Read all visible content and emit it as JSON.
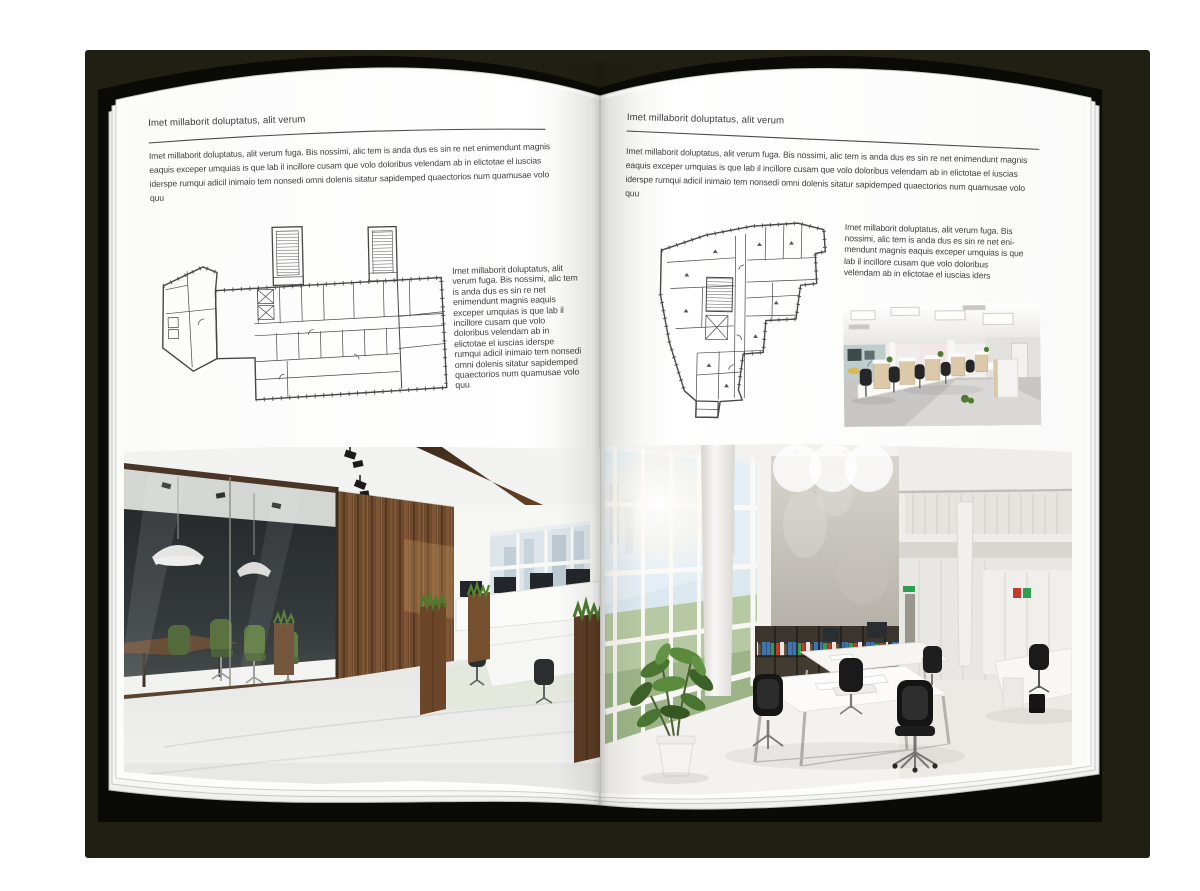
{
  "scene": {
    "type": "open-magazine-spread-mockup",
    "backdrop_color": "#201f13",
    "cover_color": "#0a0a06",
    "page_color": "#ffffff",
    "text_color": "#3e3e3e"
  },
  "left_page": {
    "header": "Imet millaborit doluptatus, alit verum",
    "intro": "Imet millaborit doluptatus, alit verum fuga. Bis nossimi, alic tem is anda dus es sin re net enimendunt magnis eaquis exceper umquias is que lab il incillore cusam que volo doloribus velendam ab in elictotae el iuscias iderspe rumqui adicil inimaio tem nonsedi omni dolenis sitatur sapidemped quaectorios num quamusae volo quu",
    "side_text": "Imet millaborit doluptatus, alit verum fuga. Bis nossimi, alic tem is anda dus es sin re net enimendunt magnis eaquis exceper umquias is que lab il incillore cusam que volo doloribus velendam ab in elictotae el iuscias iderspe rumqui adicil inimaio tem nonsedi omni dolenis sitatur sapidemped quaectorios num quamusae volo quu",
    "floor_plan": "architectural-floor-plan-wide-building-with-two-stair-towers",
    "photo": "office-interior-dark-wood-wall-glass-meeting-room-green-chairs"
  },
  "right_page": {
    "header": "Imet millaborit doluptatus, alit verum",
    "intro": "Imet millaborit doluptatus, alit verum fuga. Bis nossimi, alic tem is anda dus es sin re net enimendunt magnis eaquis exceper umquias is que lab il incillore cusam que volo doloribus velendam ab in elictotae el iuscias iderspe rumqui adicil inimaio tem nonsedi omni dolenis sitatur sapidemped quaectorios num quamusae volo quu",
    "side_text": "Imet millaborit doluptatus, alit verum fuga. Bis nossimi, alic tem is anda dus es sin re net eni-mendunt magnis eaquis exceper umquias is que lab il incillore cusam que volo doloribus velendam ab in elictotae el iuscias iders",
    "floor_plan": "architectural-floor-plan-irregular-footprint-building",
    "photo_small": "office-interior-white-cubicles-black-chairs",
    "photo_large": "office-interior-bright-atrium-bookshelves-white-desks"
  }
}
